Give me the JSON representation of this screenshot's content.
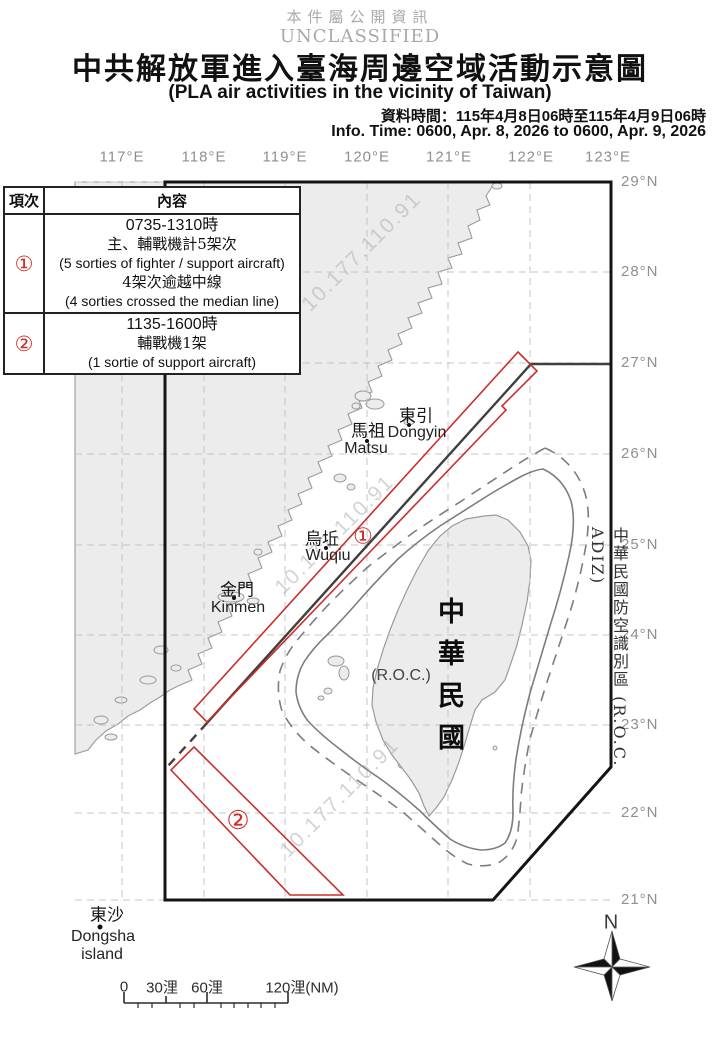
{
  "header": {
    "classification_cn": "本件屬公開資訊",
    "classification_en": "UNCLASSIFIED",
    "title_cn": "中共解放軍進入臺海周邊空域活動示意圖",
    "title_en": "(PLA air activities in the vicinity of Taiwan)",
    "info_time_cn": "資料時間：115年4月8日06時至115年4月9日06時",
    "info_time_en": "Info. Time: 0600, Apr. 8, 2026 to 0600, Apr. 9, 2026"
  },
  "legend_table": {
    "header": {
      "item": "項次",
      "content": "內容"
    },
    "rows": [
      {
        "num": "①",
        "lines": [
          "0735-1310時",
          "主、輔戰機計5架次",
          "(5 sorties of fighter / support aircraft)",
          "4架次逾越中線",
          "(4 sorties crossed the median line)"
        ]
      },
      {
        "num": "②",
        "lines": [
          "1135-1600時",
          "輔戰機1架",
          "(1 sortie of support aircraft)"
        ]
      }
    ]
  },
  "axes": {
    "lon": [
      "117°E",
      "118°E",
      "119°E",
      "120°E",
      "121°E",
      "122°E",
      "123°E"
    ],
    "lat": [
      "29°N",
      "28°N",
      "27°N",
      "26°N",
      "25°N",
      "24°N",
      "23°N",
      "22°N",
      "21°N"
    ]
  },
  "places": {
    "dongyin": {
      "cn": "東引",
      "en": "Dongyin"
    },
    "matsu": {
      "cn": "馬祖",
      "en": "Matsu"
    },
    "wuqiu": {
      "cn": "烏坵",
      "en": "Wuqiu"
    },
    "kinmen": {
      "cn": "金門",
      "en": "Kinmen"
    },
    "dongsha": {
      "cn": "東沙",
      "en_line1": "Dongsha",
      "en_line2": "island"
    }
  },
  "taiwan": {
    "name_cn": "中華民國",
    "name_en": "(R.O.C.)"
  },
  "adiz": {
    "label": "中華民國防空識別區 (R.O.C. ADIZ)"
  },
  "routes": {
    "r1": "①",
    "r2": "②"
  },
  "scalebar": {
    "t0": "0",
    "t30": "30浬",
    "t60": "60浬",
    "t120": "120浬(NM)"
  },
  "compass": {
    "north": "N"
  },
  "watermark": {
    "text": "10.177.110.91"
  },
  "colors": {
    "route_red": "#cb2f28",
    "adiz_black": "#141414",
    "boundary_grey": "#7d7d7d",
    "median_grey": "#3f3f3f",
    "land_grey": "#ececec",
    "grid_grey": "#c4c4c4"
  }
}
